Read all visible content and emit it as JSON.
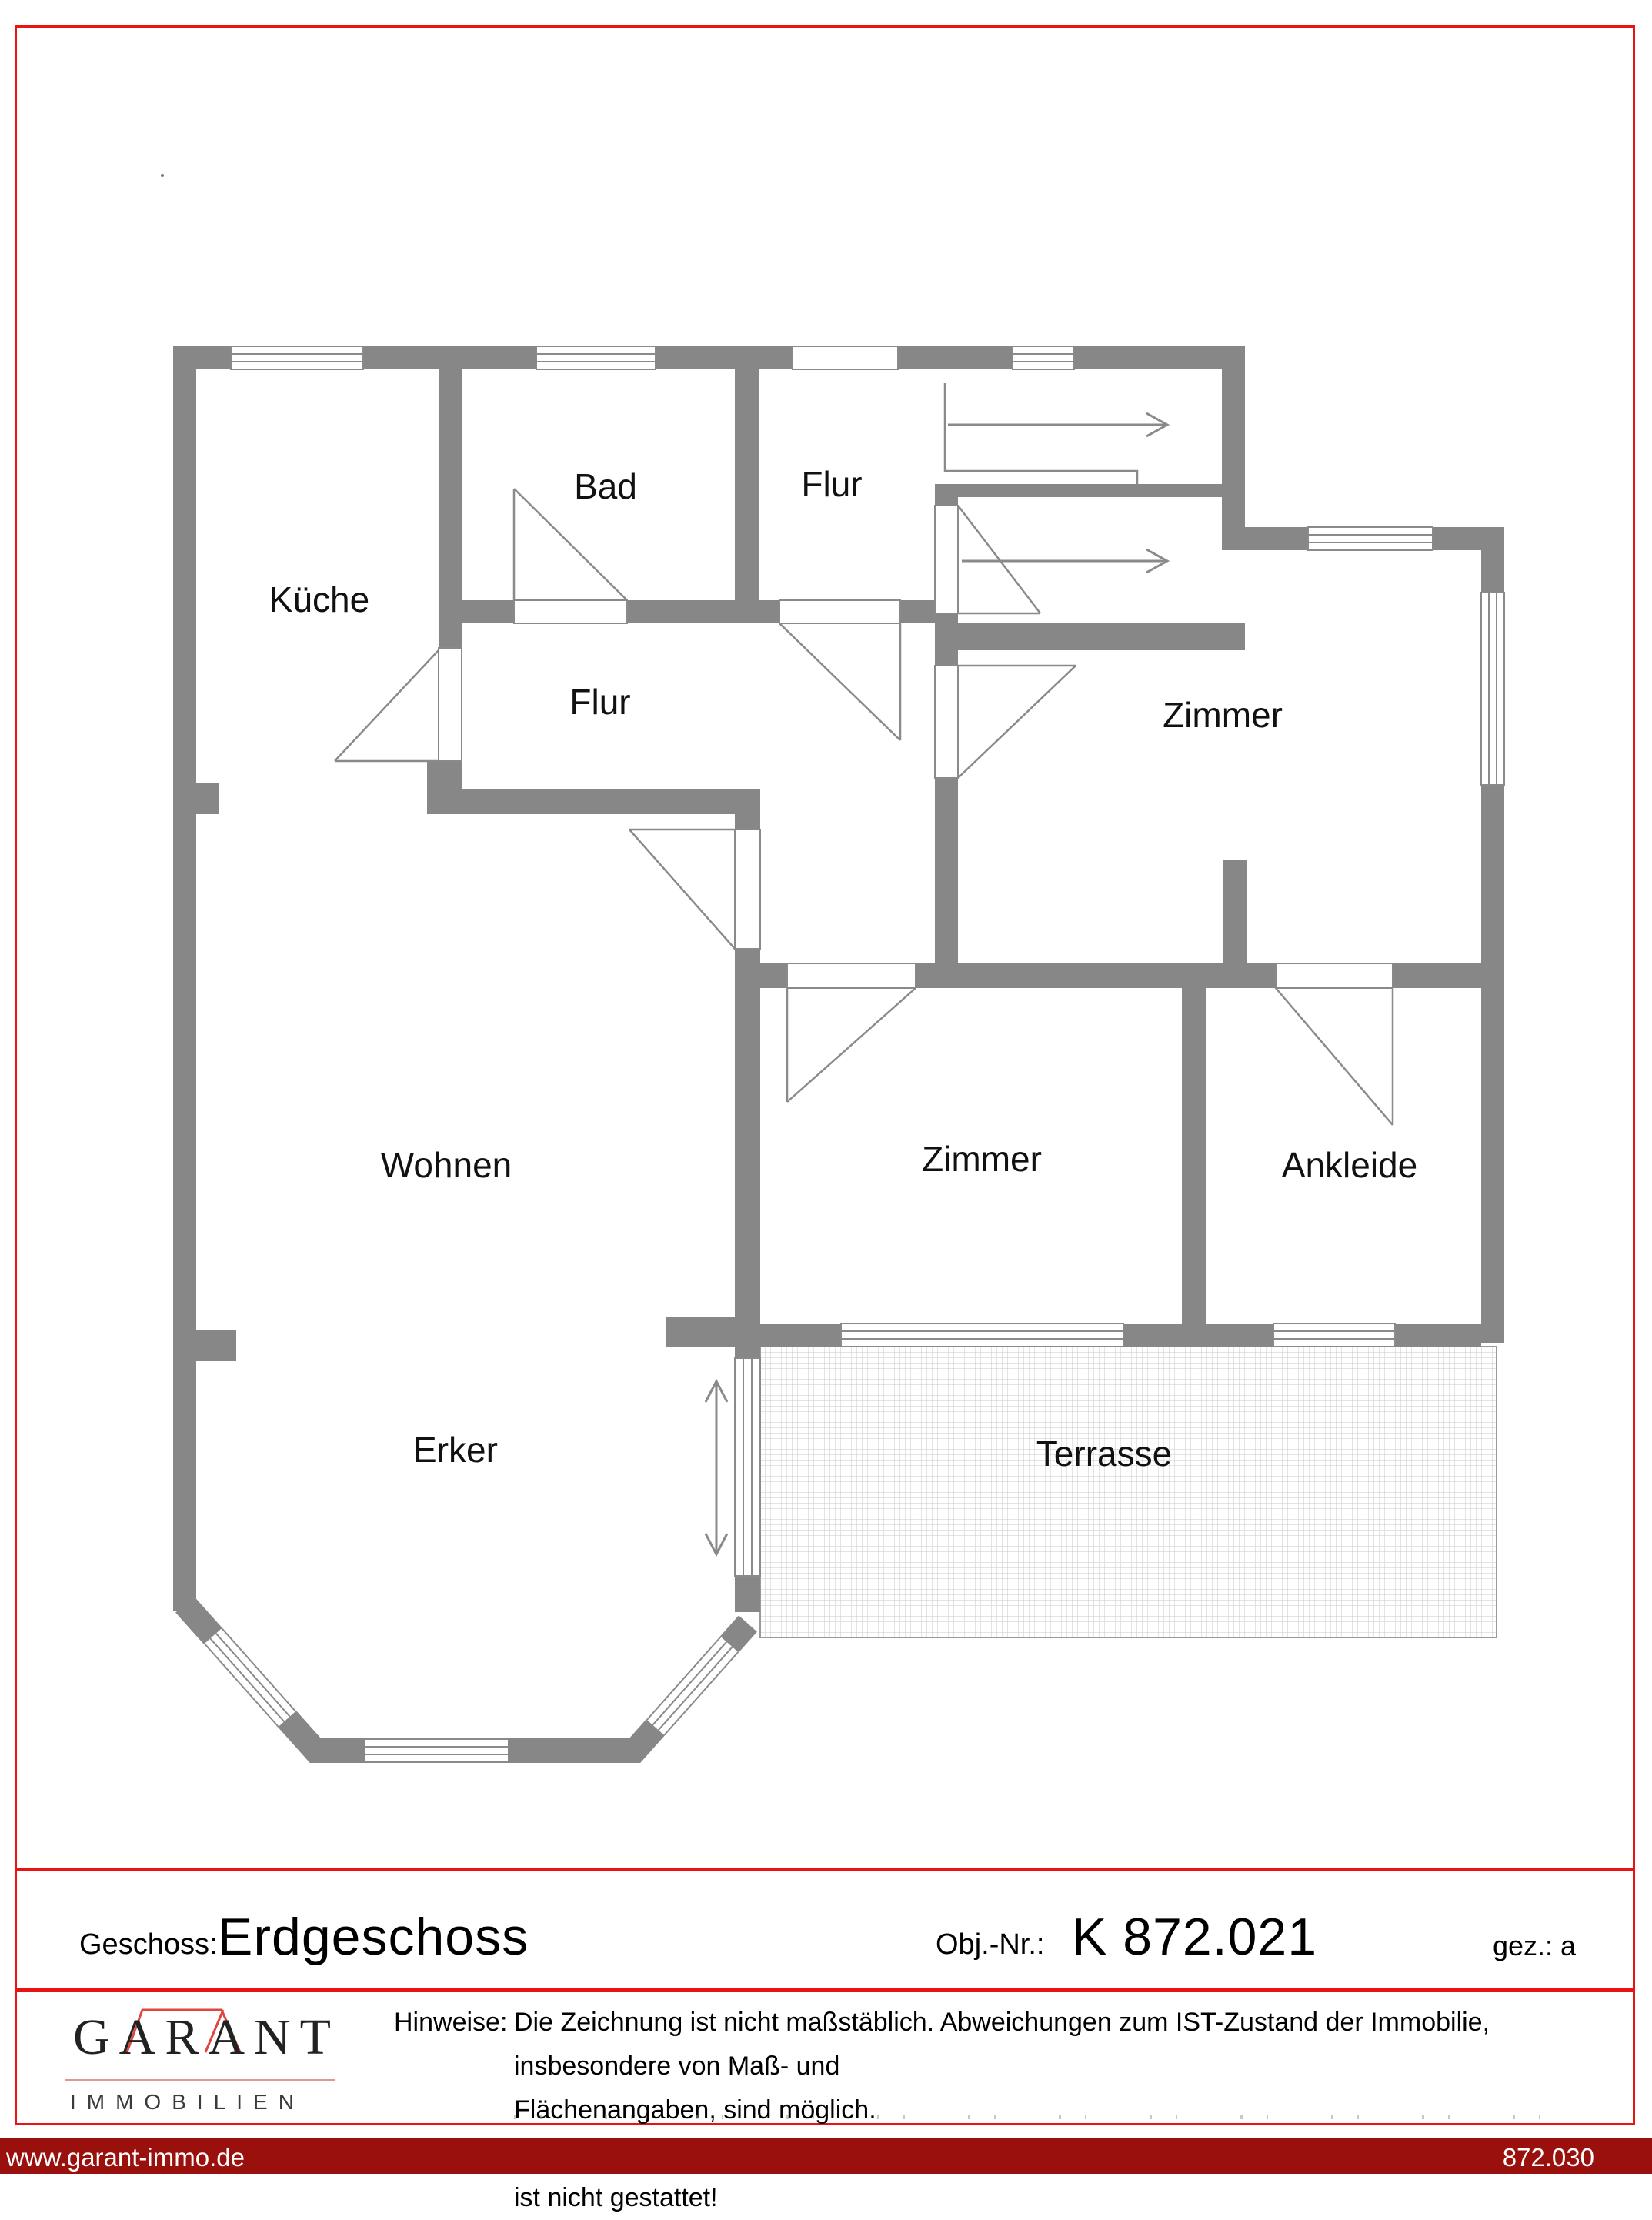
{
  "plan": {
    "rooms": [
      {
        "id": "kueche",
        "label": "Küche"
      },
      {
        "id": "bad",
        "label": "Bad"
      },
      {
        "id": "flur-oben",
        "label": "Flur"
      },
      {
        "id": "flur-mitte",
        "label": "Flur"
      },
      {
        "id": "zimmer-oben",
        "label": "Zimmer"
      },
      {
        "id": "wohnen",
        "label": "Wohnen"
      },
      {
        "id": "zimmer-unten",
        "label": "Zimmer"
      },
      {
        "id": "ankleide",
        "label": "Ankleide"
      },
      {
        "id": "erker",
        "label": "Erker"
      },
      {
        "id": "terrasse",
        "label": "Terrasse"
      }
    ]
  },
  "title_block": {
    "geschoss_label": "Geschoss:",
    "geschoss_value": "Erdgeschoss",
    "obj_label": "Obj.-Nr.:",
    "obj_value": "K 872.021",
    "gez_label": "gez.:",
    "gez_value": "a"
  },
  "logo": {
    "name": "GARANT",
    "subtitle": "IMMOBILIEN"
  },
  "hinweise": {
    "label": "Hinweise:",
    "line1": "Die Zeichnung ist nicht maßstäblich. Abweichungen zum IST-Zustand der Immobilie, insbesondere von Maß- und",
    "line2": "Flächenangaben, sind möglich.",
    "line3": "Kopieren oder Vervielfältigen ohne Zustimmung der Garant Immobilien Unternehmensgruppe ist nicht gestattet!"
  },
  "footer": {
    "left": "www.garant-immo.de",
    "right": "872.030"
  },
  "colors": {
    "border_red": "#e81414",
    "footer_maroon": "#9a100d",
    "wall_gray": "#878787",
    "logo_red": "#e1453f"
  }
}
